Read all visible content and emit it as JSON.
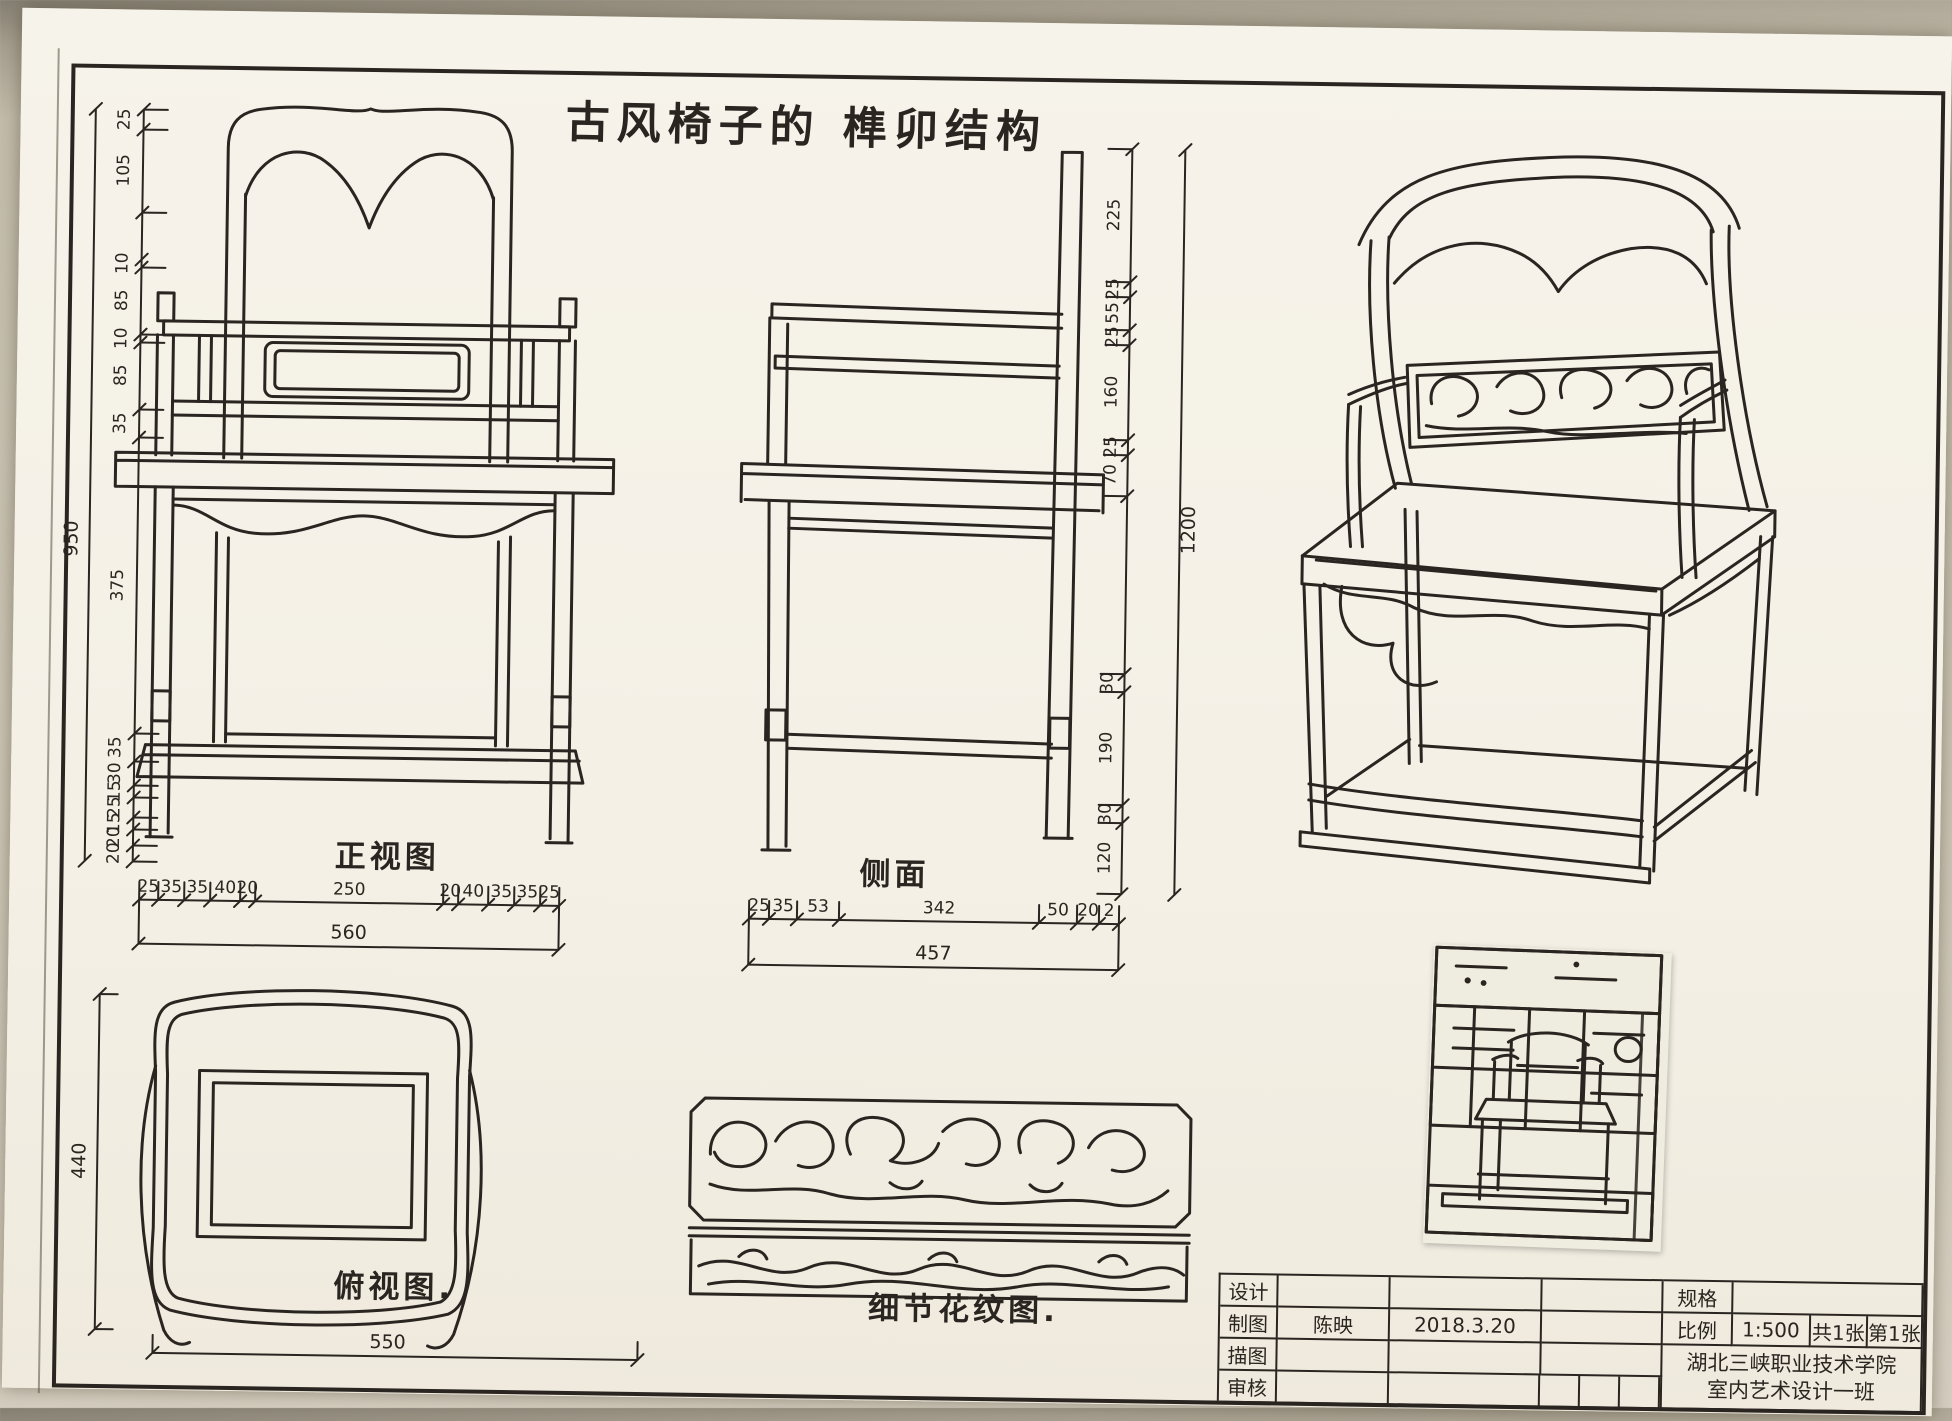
{
  "sheet": {
    "title": "古风椅子的 榫卯结构"
  },
  "views": {
    "front": {
      "label": "正视图"
    },
    "side": {
      "label": "侧面"
    },
    "top": {
      "label": "俯视图."
    },
    "detail": {
      "label": "细节花纹图."
    }
  },
  "dimensions": {
    "front_left": {
      "values": [
        "25",
        "105",
        "10",
        "85",
        "10",
        "85",
        "35",
        "375",
        "35",
        "30",
        "15",
        "25",
        "15",
        "20",
        "20"
      ],
      "total": "950"
    },
    "front_bottom": {
      "values": [
        "25",
        "35",
        "35",
        "40",
        "20",
        "250",
        "20",
        "40",
        "35",
        "35",
        "25"
      ],
      "total": "560"
    },
    "side_bottom": {
      "values": [
        "25",
        "35",
        "53",
        "342",
        "50",
        "20",
        "2"
      ],
      "total": "457"
    },
    "side_right": {
      "values": [
        "225",
        "25",
        "55",
        "25",
        "160",
        "25",
        "70",
        "30",
        "190",
        "30",
        "120"
      ],
      "total": "1200"
    },
    "top_left": {
      "total": "440"
    },
    "top_bottom": {
      "total": "550"
    }
  },
  "title_block": {
    "rows": [
      {
        "label": "设计",
        "name": "",
        "date": ""
      },
      {
        "label": "制图",
        "name": "陈映",
        "date": "2018.3.20"
      },
      {
        "label": "描图",
        "name": "",
        "date": ""
      },
      {
        "label": "审核",
        "name": "",
        "date": ""
      }
    ],
    "spec_label": "规格",
    "scale_label": "比例",
    "scale_value": "1:500",
    "sheet_count": "共1张",
    "sheet_index": "第1张",
    "school": "湖北三峡职业技术学院",
    "class_name": "室内艺术设计一班"
  },
  "colors": {
    "ink": "#2a2520",
    "paper": "#f5f2e9"
  }
}
